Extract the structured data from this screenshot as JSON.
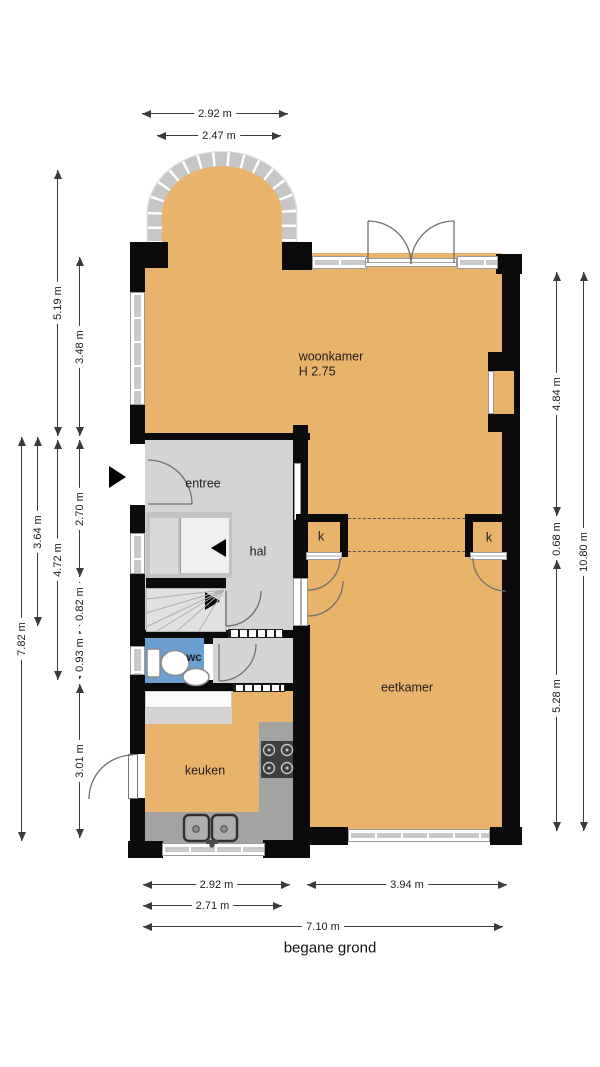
{
  "title": "begane grond",
  "rooms": [
    {
      "id": "woonkamer",
      "label": "woonkamer",
      "sub": "H 2.75",
      "x": 331,
      "y": 357
    },
    {
      "id": "entree",
      "label": "entree",
      "x": 203,
      "y": 484
    },
    {
      "id": "hal",
      "label": "hal",
      "x": 258,
      "y": 552
    },
    {
      "id": "wc",
      "label": "wc",
      "x": 194,
      "y": 659,
      "bold": true
    },
    {
      "id": "keuken",
      "label": "keuken",
      "x": 205,
      "y": 771
    },
    {
      "id": "eetkamer",
      "label": "eetkamer",
      "x": 407,
      "y": 688
    },
    {
      "id": "kast-links",
      "label": "k",
      "x": 321,
      "y": 537
    },
    {
      "id": "kast-rechts",
      "label": "k",
      "x": 489,
      "y": 538
    }
  ],
  "dimensions": [
    {
      "id": "top-erker-buiten",
      "label": "2.92 m",
      "orient": "h",
      "x": 142,
      "y": 113,
      "len": 146
    },
    {
      "id": "top-erker-binnen",
      "label": "2.47 m",
      "orient": "h",
      "x": 157,
      "y": 135,
      "len": 124
    },
    {
      "id": "links-totaal",
      "label": "7.82 m",
      "orient": "v",
      "x": 21,
      "y": 437,
      "len": 404
    },
    {
      "id": "links-364",
      "label": "3.64 m",
      "orient": "v",
      "x": 37,
      "y": 437,
      "len": 189
    },
    {
      "id": "links-519",
      "label": "5.19 m",
      "orient": "v",
      "x": 57,
      "y": 170,
      "len": 266
    },
    {
      "id": "links-472",
      "label": "4.72 m",
      "orient": "v",
      "x": 57,
      "y": 440,
      "len": 240
    },
    {
      "id": "links-348",
      "label": "3.48 m",
      "orient": "v",
      "x": 79,
      "y": 257,
      "len": 179
    },
    {
      "id": "links-270",
      "label": "2.70 m",
      "orient": "v",
      "x": 79,
      "y": 440,
      "len": 137
    },
    {
      "id": "links-082",
      "label": "0.82 m",
      "orient": "v",
      "x": 79,
      "y": 582,
      "len": 44
    },
    {
      "id": "links-093",
      "label": "0.93 m",
      "orient": "v",
      "x": 79,
      "y": 631,
      "len": 48
    },
    {
      "id": "links-301",
      "label": "3.01 m",
      "orient": "v",
      "x": 79,
      "y": 684,
      "len": 154
    },
    {
      "id": "rechts-484",
      "label": "4.84 m",
      "orient": "v",
      "x": 556,
      "y": 272,
      "len": 244
    },
    {
      "id": "rechts-068",
      "label": "0.68 m",
      "orient": "v",
      "x": 556,
      "y": 521,
      "len": 35
    },
    {
      "id": "rechts-528",
      "label": "5.28 m",
      "orient": "v",
      "x": 556,
      "y": 560,
      "len": 271
    },
    {
      "id": "rechts-totaal",
      "label": "10.80 m",
      "orient": "v",
      "x": 583,
      "y": 272,
      "len": 559
    },
    {
      "id": "onder-keuken",
      "label": "2.92 m",
      "orient": "h",
      "x": 143,
      "y": 884,
      "len": 147
    },
    {
      "id": "onder-eetkamer",
      "label": "3.94 m",
      "orient": "h",
      "x": 307,
      "y": 884,
      "len": 200
    },
    {
      "id": "onder-271",
      "label": "2.71 m",
      "orient": "h",
      "x": 143,
      "y": 905,
      "len": 139
    },
    {
      "id": "onder-totaal",
      "label": "7.10 m",
      "orient": "h",
      "x": 143,
      "y": 926,
      "len": 360
    }
  ],
  "title_pos": {
    "x": 330,
    "y": 948
  },
  "icons": [
    "entrance-arrow",
    "stairs-up-arrow",
    "stairs-down-arrow",
    "toilet",
    "washbasin",
    "kitchen-sink",
    "stove"
  ],
  "colors": {
    "floor": "#eab36b",
    "hall": "#d4d4d4",
    "wc_blue": "#6b9fd4",
    "wall": "#0b0b0b",
    "counter": "#a3a3a1"
  }
}
